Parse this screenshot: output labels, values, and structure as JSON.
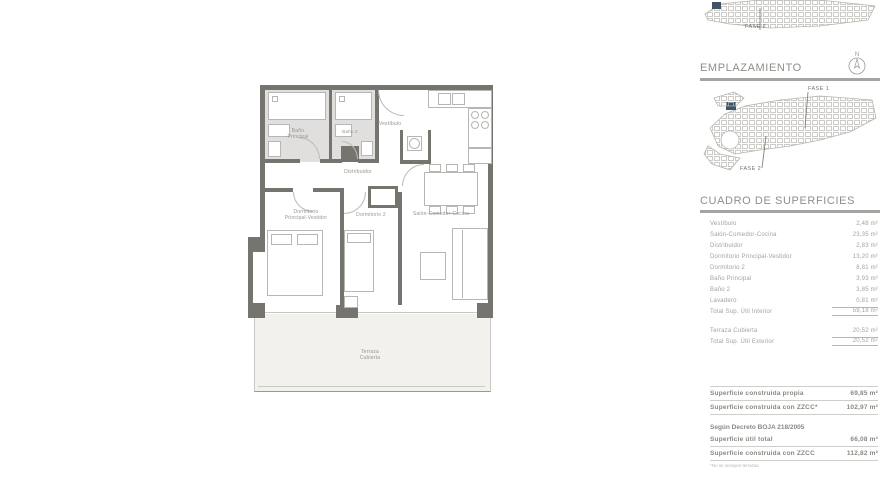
{
  "floor_plan": {
    "labels": {
      "bano_principal_1": "Baño",
      "bano_principal_2": "Principal",
      "bano_2": "Baño 2",
      "vestibulo": "Vestíbulo",
      "distribuidor": "Distribuidor",
      "dorm_ppal_1": "Dormitorio",
      "dorm_ppal_2": "Principal-Vestidor",
      "dorm_2": "Dormitorio 2",
      "salon": "Salón-Comedor-Cocina",
      "terraza_1": "Terraza",
      "terraza_2": "Cubierta"
    }
  },
  "sidebar": {
    "top_map": {
      "fase_label": "FASE 2"
    },
    "emplazamiento": {
      "title": "EMPLAZAMIENTO",
      "compass": "N",
      "fase1_label": "FASE 1",
      "fase2_label": "FASE 2"
    },
    "surfaces": {
      "title": "CUADRO DE SUPERFICIES",
      "rows": [
        {
          "label": "Vestíbulo",
          "value": "2,48 m²"
        },
        {
          "label": "Salón-Comedor-Cocina",
          "value": "23,35 m²"
        },
        {
          "label": "Distribuidor",
          "value": "2,83 m²"
        },
        {
          "label": "Dormitorio Principal-Vestidor",
          "value": "13,20 m²"
        },
        {
          "label": "Dormitorio 2",
          "value": "8,81 m²"
        },
        {
          "label": "Baño Principal",
          "value": "3,93 m²"
        },
        {
          "label": "Baño 2",
          "value": "3,85 m²"
        },
        {
          "label": "Lavadero",
          "value": "0,81 m²"
        }
      ],
      "total_interior": {
        "label": "Total Sup. Útil Interior",
        "value": "59,18 m²"
      },
      "exterior_rows": [
        {
          "label": "Terraza Cubierta",
          "value": "20,52 m²"
        }
      ],
      "total_exterior": {
        "label": "Total Sup. Útil Exterior",
        "value": "20,52 m²"
      }
    },
    "built": {
      "rows": [
        {
          "label": "Superficie construida propia",
          "value": "69,85 m²"
        },
        {
          "label": "Superficie construida con ZZCC*",
          "value": "102,97 m²"
        }
      ],
      "decree_title": "Según Decreto BOJA 218/2005",
      "decree_rows": [
        {
          "label": "Superficie útil total",
          "value": "66,08 m²"
        },
        {
          "label": "Superficie construida con ZZCC",
          "value": "112,82 m²"
        }
      ],
      "footnote": "*No se incluyen terrazas"
    }
  }
}
